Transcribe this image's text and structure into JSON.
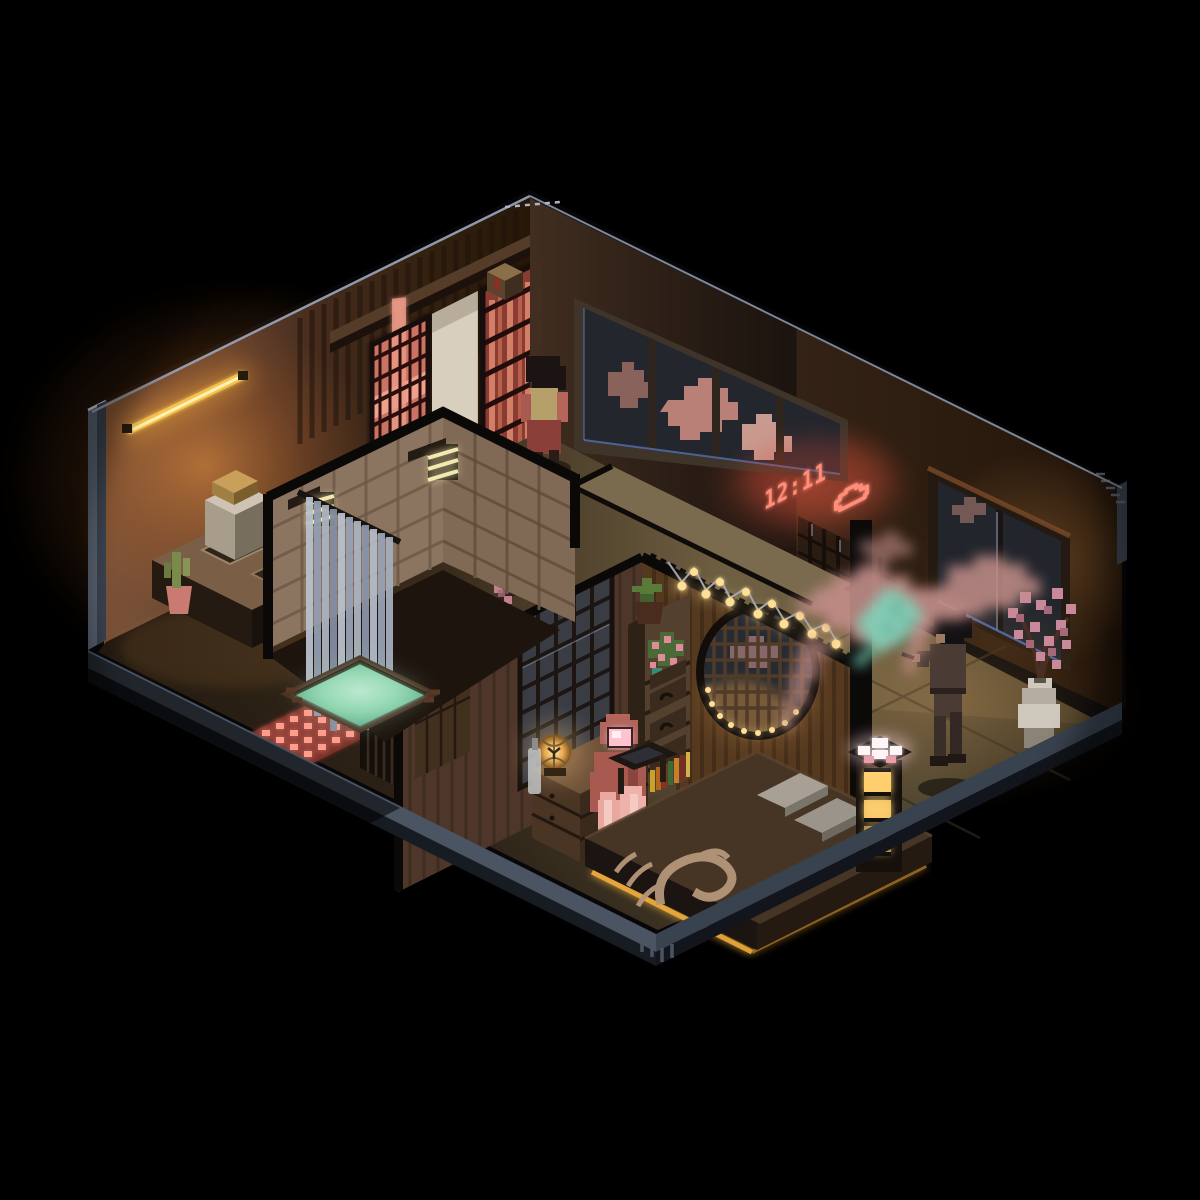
{
  "scene": {
    "title": "Isometric voxel apartment diorama at night",
    "style": "voxel cutaway, dark ambient lighting",
    "clock": {
      "time": "12:11",
      "weather_icon": "cloud"
    },
    "rooms": {
      "kitchen": "kitchen nook with yellow tube light, counter with two sinks, cactus pot, glowing pink floor grid",
      "entry": "entry hall with backlit red kumiko lattice panels, cream door and standing resident",
      "bathroom": "tiled bathroom cube with slatted wall lamps, grey shower curtain, sunken teal bathtub",
      "bedroom": "bedroom with round moon lattice window, string lights, plant shelf, lantern dresser, futon bed with crane blanket",
      "living": "tatami room with large night windows, projected clock, smoking figure, pink smoke forming a teal koi, cherry-blossom vase"
    },
    "figures": [
      {
        "name": "figure-entry",
        "desc": "person with dark bob hair standing by red lattice door"
      },
      {
        "name": "figure-bedroom",
        "desc": "seated figure in salmon robe with glowing pink visor at a low desk"
      },
      {
        "name": "figure-living",
        "desc": "standing figure smoking by the window, smoke drifting as a koi"
      }
    ],
    "colors": {
      "background": "#000000",
      "outline": "#97a1b4",
      "platform_trim": "#4a5462",
      "platform_trim_dark": "#39424f",
      "cut_wall": "#57616f",
      "tube_light": "#ffd04f",
      "lattice_glow": "#d4766a",
      "door_cream": "#d9cfbf",
      "tile_beige": "#b9a089",
      "lamp_slat": "#f3e9b0",
      "curtain_gray": "#aab3c0",
      "tub_water": "#8fd4ae",
      "slat_wall": "#5d4233",
      "blossom_decal": "#d98ea0",
      "moon_glass": "#262b33",
      "bulb_warm": "#ffdf96",
      "rose_pink": "#e08a9a",
      "robe_salmon": "#b5655a",
      "visor_pink": "#ffc3cf",
      "lantern_glow": "#ffd08a",
      "bed_top": "#463424",
      "crane_tan": "#b5977a",
      "pillow_gray": "#a8a095",
      "underbed_glow": "#f7b23e",
      "window_glass": "#23262d",
      "cloud_outside": "#b98078",
      "clock_glow": "#ff8d78",
      "smoke_pink": "#c38e88",
      "koi_teal": "#7fd2ba",
      "tatami": "#74654a",
      "vase_stone": "#cfc8bd",
      "compartment_glow": "#ffcf6e"
    }
  }
}
